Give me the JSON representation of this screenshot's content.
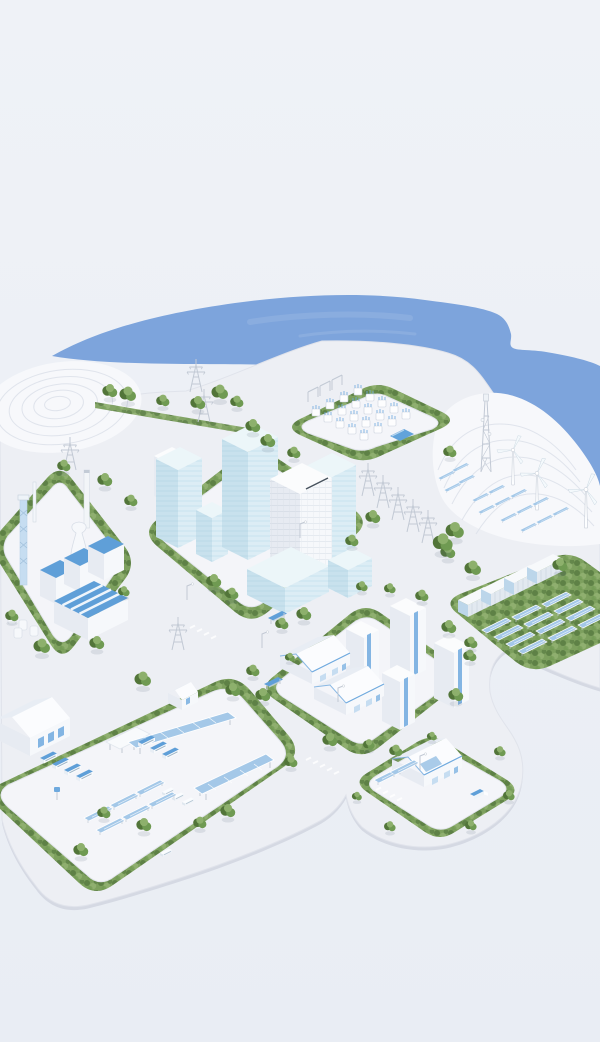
{
  "colors": {
    "bg1": "#eff2f7",
    "bg2": "#e9edf4",
    "water": "#7da4dc",
    "waterLight": "#a7c0e9",
    "base": "#edeff4",
    "baseSide": "#d5d9e3",
    "baseLine": "#dde1ea",
    "platform": "#f4f5f9",
    "platformLine": "#e2e5ec",
    "hedge": "#7da05e",
    "hedgeDark": "#5e8146",
    "hedgeLight": "#97b577",
    "tree1": "#6f9a52",
    "tree2": "#527539",
    "treeLight": "#8db06c",
    "steel": "#c2c9d4",
    "accentBlue": "#6ea9de",
    "roofBlue": "#5f9fd8",
    "solarBlue": "#a4c8e8",
    "solarLight": "#c6ddf1",
    "glassLeft": "#c8e1ed",
    "glassRight": "#dcedf5",
    "glassTop": "#ecf6f9",
    "glassLine": "#aed2e4",
    "bldgLeft": "#e7ebf2",
    "bldgRight": "#f6f8fb",
    "bldgTop": "#fbfcfd",
    "bldgShade": "#dbe1ea",
    "poolBlue": "#62a3db",
    "dark": "#49545f"
  },
  "inventory": {
    "districts": [
      "power-substation",
      "downtown-offices",
      "industrial-plant",
      "residential-block",
      "battery-solar-park",
      "bus-depot-logistics",
      "single-house-lot",
      "coastal-wind-farm"
    ],
    "wind_turbines": 3,
    "battery_containers": 4,
    "solar_field_panels": 12,
    "solar_canopies": 2,
    "office_towers": 7,
    "apartment_towers": 4,
    "houses": 3,
    "buses": 7,
    "vans": 3,
    "transmission_pylons": 9,
    "bus_shelters": 2,
    "telecom_towers": 1,
    "terraced_hills": 2,
    "vehicles_on_road": 2
  }
}
